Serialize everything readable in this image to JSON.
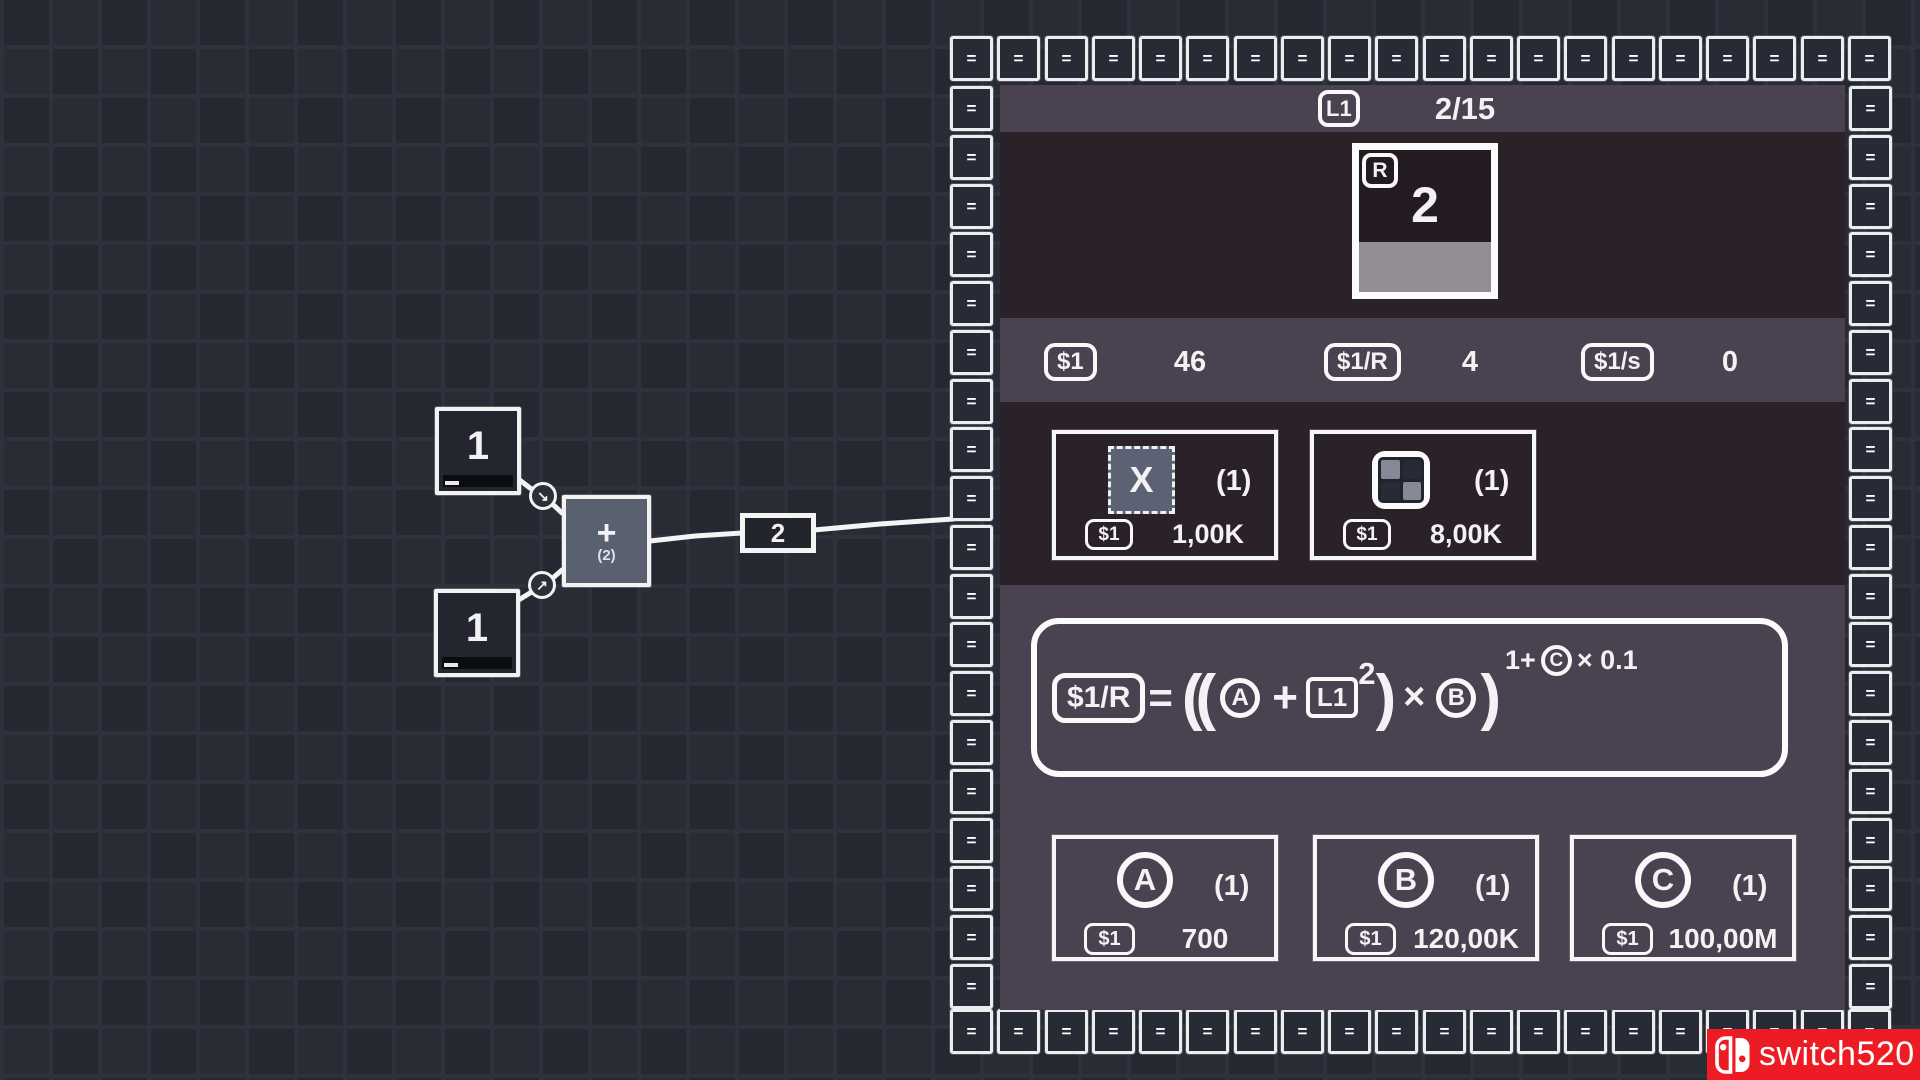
{
  "colors": {
    "page_bg_cell_a": "#282c35",
    "page_bg_cell_b": "#242831",
    "panel_dark": "#2a2129",
    "panel_light": "#4a4250",
    "tile_fill": "#262b36",
    "stroke_white": "#f2f2f2",
    "adder_fill": "#596070",
    "source_fill": "#23262e",
    "reactor_progress_fill": "#958d95",
    "watermark_red": "#ed1c24"
  },
  "graph": {
    "source_top": {
      "value": "1"
    },
    "source_bottom": {
      "value": "1"
    },
    "adder": {
      "operator": "+",
      "buffer": "(2)"
    },
    "wire_label": "2",
    "connector_top_arrow": "↘",
    "connector_bottom_arrow": "↗"
  },
  "panel": {
    "header": {
      "level_badge": "L1",
      "progress": "2/15"
    },
    "reactor": {
      "corner_badge": "R",
      "value": "2",
      "progress_percent": 35
    },
    "currencies": [
      {
        "badge": "$1",
        "value": "46"
      },
      {
        "badge": "$1/R",
        "value": "4"
      },
      {
        "badge": "$1/s",
        "value": "0"
      }
    ],
    "upgrades": [
      {
        "icon": "x-multiplier-icon",
        "icon_letter": "X",
        "count": "(1)",
        "cost_badge": "$1",
        "cost": "1,00K"
      },
      {
        "icon": "grid-expand-icon",
        "count": "(1)",
        "cost_badge": "$1",
        "cost": "8,00K"
      }
    ],
    "formula": {
      "lhs_badge": "$1/R",
      "equals": "=",
      "open_parens": "((",
      "var_a": "A",
      "plus": "+",
      "level_badge": "L1",
      "level_exponent": "2",
      "inner_close_paren": ")",
      "multiply": "×",
      "var_b": "B",
      "outer_close_paren": ")",
      "exponent_prefix": "1+",
      "exponent_var": "C",
      "exponent_suffix": "× 0.1"
    },
    "variables": [
      {
        "letter": "A",
        "count": "(1)",
        "cost_badge": "$1",
        "cost": "700"
      },
      {
        "letter": "B",
        "count": "(1)",
        "cost_badge": "$1",
        "cost": "120,00K"
      },
      {
        "letter": "C",
        "count": "(1)",
        "cost_badge": "$1",
        "cost": "100,00M"
      }
    ],
    "frame_tile_glyph": "="
  },
  "watermark": {
    "brand": "switch520"
  }
}
